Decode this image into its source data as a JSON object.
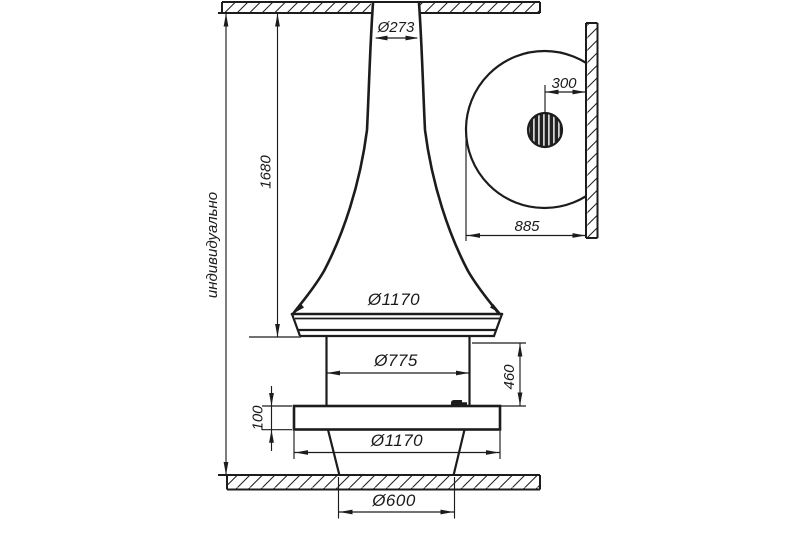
{
  "page": {
    "background": "#ffffff",
    "line_color": "#1c1c1c"
  },
  "labels": {
    "chimney_dia": "Ø273",
    "ceiling_distance": "индивидуально",
    "hood_height": "1680",
    "hood_rim_dia": "Ø1170",
    "body_dia": "Ø775",
    "body_height": "460",
    "plate_thickness": "100",
    "plate_dia": "Ø1170",
    "base_dia": "Ø600",
    "pipe_to_wall": "300",
    "edge_to_wall": "885"
  }
}
